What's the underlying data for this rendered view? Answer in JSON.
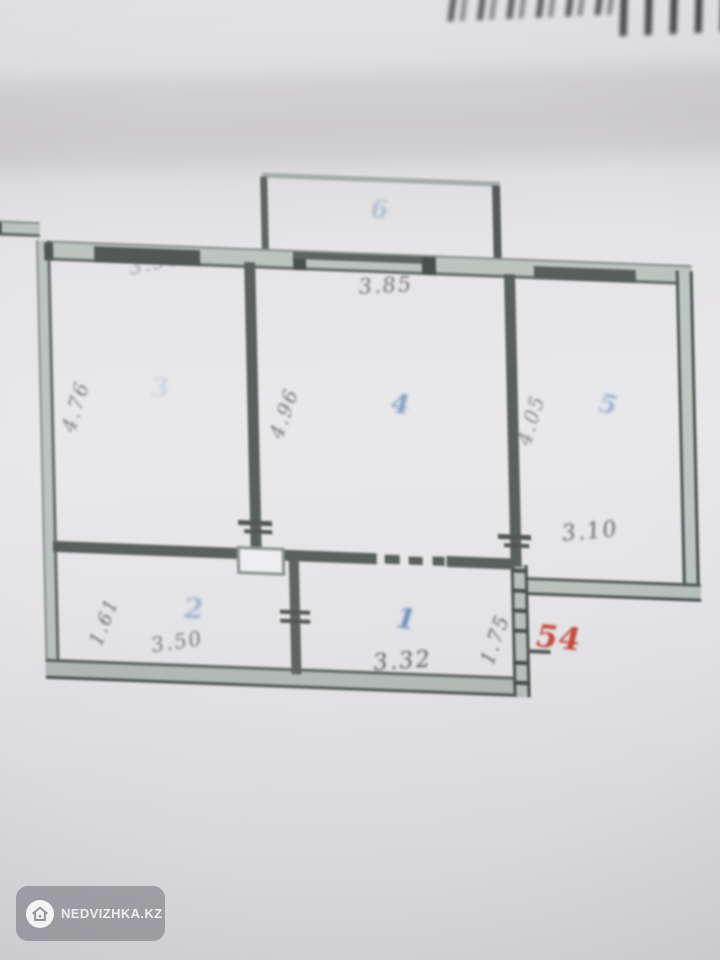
{
  "photo": {
    "description": "blurred photo of an apartment floor plan",
    "watermark": {
      "brand": "NEDVIZHKA.KZ",
      "icon": "house-icon"
    }
  },
  "plan": {
    "total_area_note": "54",
    "room_numbers": {
      "balcony": "6",
      "room1": "1",
      "room2": "2",
      "room3": "3",
      "room4": "4",
      "room5": "5"
    },
    "dimensions": {
      "top_left_width": "3.56",
      "top_middle_width": "3.85",
      "left_height": "4.76",
      "middle_height": "4.96",
      "right_height": "4.05",
      "room5_bottom_width": "3.10",
      "room2_left_height": "1.61",
      "room2_bottom_width": "3.50",
      "room1_bottom_width": "3.32",
      "room1_right_height": "1.75"
    }
  },
  "colors": {
    "paper": "#e2e1e4",
    "wall_dark": "#474e4b",
    "wall_light": "#b6bfbb",
    "room_number_blue": "#4f7bb0",
    "area_note_red": "#c0392b"
  }
}
